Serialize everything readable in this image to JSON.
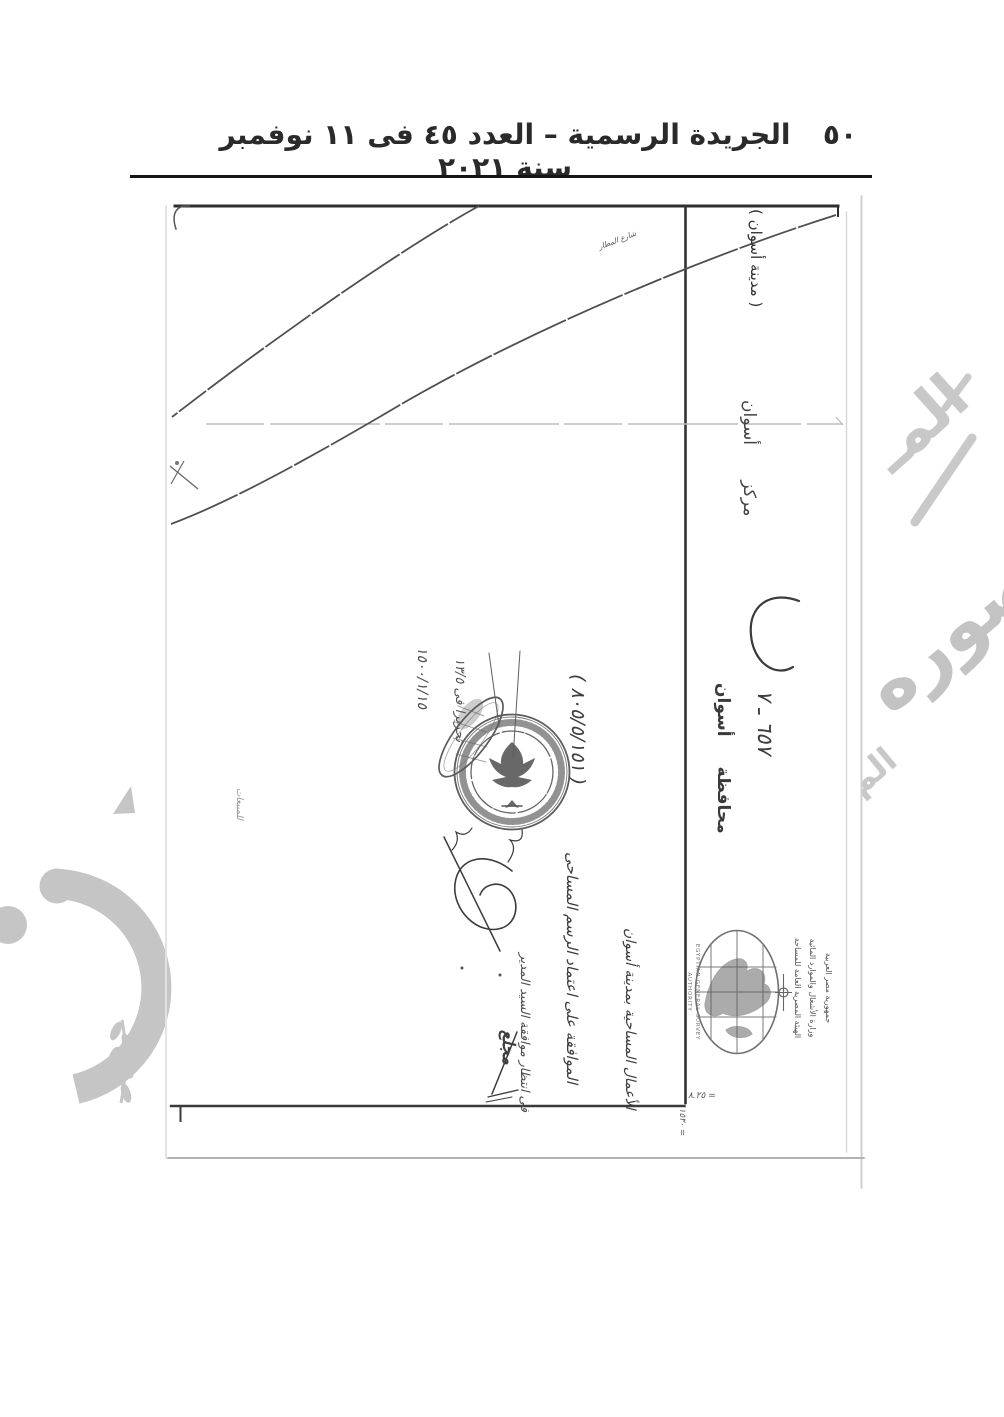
{
  "colors": {
    "ink": "#1a1a1a",
    "map_line": "#4f4f4f",
    "watermark": "#c5c5c5",
    "scan_edge": "#cfcfcf"
  },
  "header": {
    "title": "الجريدة الرسمية – العدد ٤٥ فى ١١ نوفمبر سنة ٢٠٢١",
    "page_number": "٥٠"
  },
  "map": {
    "city_label": "( مدينة أسوان )",
    "district_label": "مركز أسوان",
    "governorate_label": "محافظة أسوان",
    "ref_number": "٦٥٧ ـ ٧",
    "street_label": "شارع المطار",
    "decree_number": "( ٨٠٥/٥/١٥١ )",
    "date_note": "١٥٠٠/١/١٥",
    "release_note": "تحريرا فى ١٣/٥",
    "sales_note": "للمبيعات",
    "hw_approval": "الموافقة على اعتماد الرسم المساحى",
    "hw_works": "الأعمال المساحية بمدينة أسوان",
    "hw_pending": "فى انتظار موافقة السيد المدير",
    "hw_signature": "مجلع",
    "dim_note_a": "٨.٢٥ =",
    "dim_note_b": "١٥٣٠ ="
  },
  "logo": {
    "english": "EGYPTIAN GENERAL SURVEY AUTHORITY",
    "arabic_line1": "جمهورية مصر العربية",
    "arabic_line2": "وزارة الأشغال والموارد المائية",
    "arabic_line3": "الهيئة المصرية العامة للمساحة"
  },
  "watermark": {
    "fragment_top": "المـ",
    "fragment_mid": "صوره",
    "fragment_low": "الم"
  }
}
